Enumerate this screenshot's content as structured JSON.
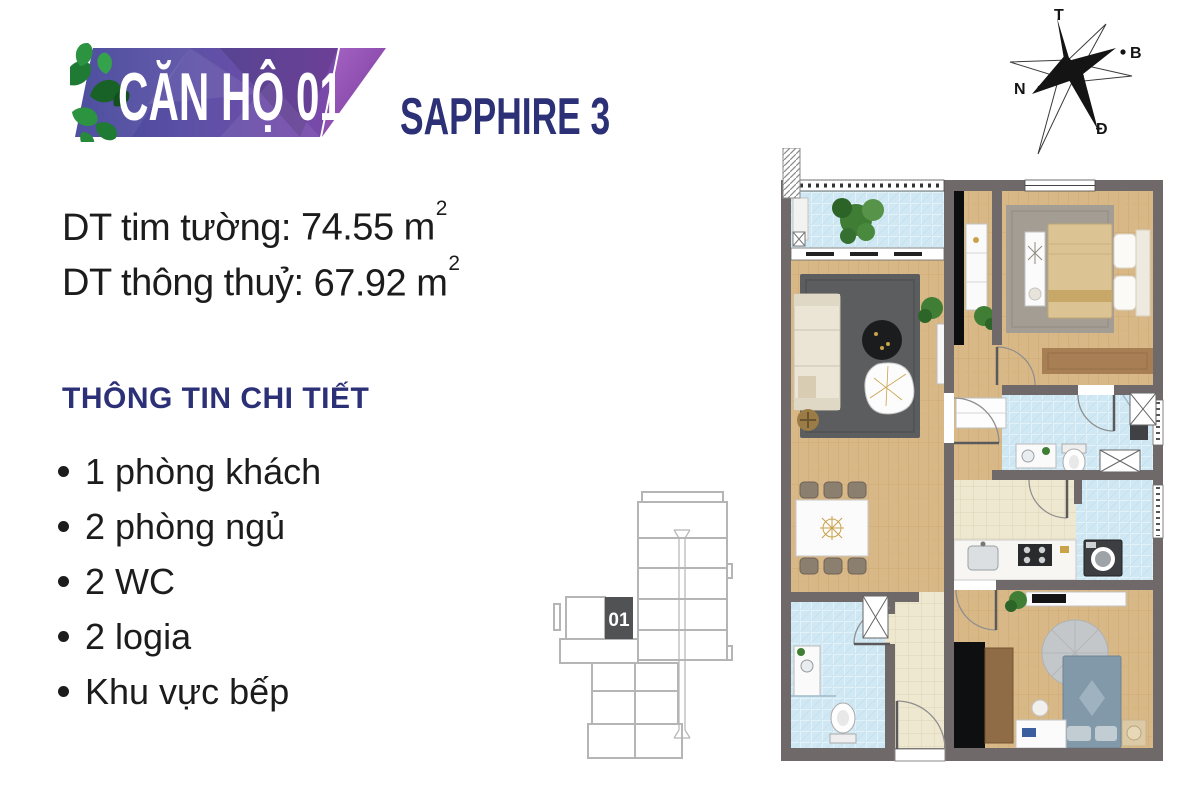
{
  "header": {
    "badge_title": "CĂN HỘ 01",
    "project_name": "SAPPHIRE 3"
  },
  "area_info": {
    "lines": [
      {
        "label": "DT tim tường:",
        "value": "74.55 m",
        "sup": "2"
      },
      {
        "label": "DT thông thuỷ:",
        "value": "67.92 m",
        "sup": "2"
      }
    ]
  },
  "details": {
    "heading": "THÔNG TIN CHI TIẾT",
    "items": [
      "1 phòng khách",
      "2 phòng ngủ",
      "2 WC",
      "2 logia",
      "Khu vực bếp"
    ]
  },
  "key_plan": {
    "highlighted_unit": "01"
  },
  "compass": {
    "labels": {
      "top": "T",
      "right": "B",
      "left": "N",
      "bottom": "Đ"
    }
  },
  "colors": {
    "navy": "#2b3077",
    "badge_gradient": [
      "#44479a",
      "#6c54ad",
      "#8a4bb0"
    ],
    "slash_purple": [
      "#a566c4",
      "#7a3f9d"
    ],
    "leaf_green": "#2c8f40",
    "wall_gray": "#6f6a69",
    "wood_floor": "#d9b888",
    "tile_blue": "#cfe8f4",
    "tile_cream": "#efe8d1",
    "rug_gray": "#5b5d5f",
    "accent_gold": "#c9a24a",
    "keyplan_unit_fill": "#515254"
  }
}
